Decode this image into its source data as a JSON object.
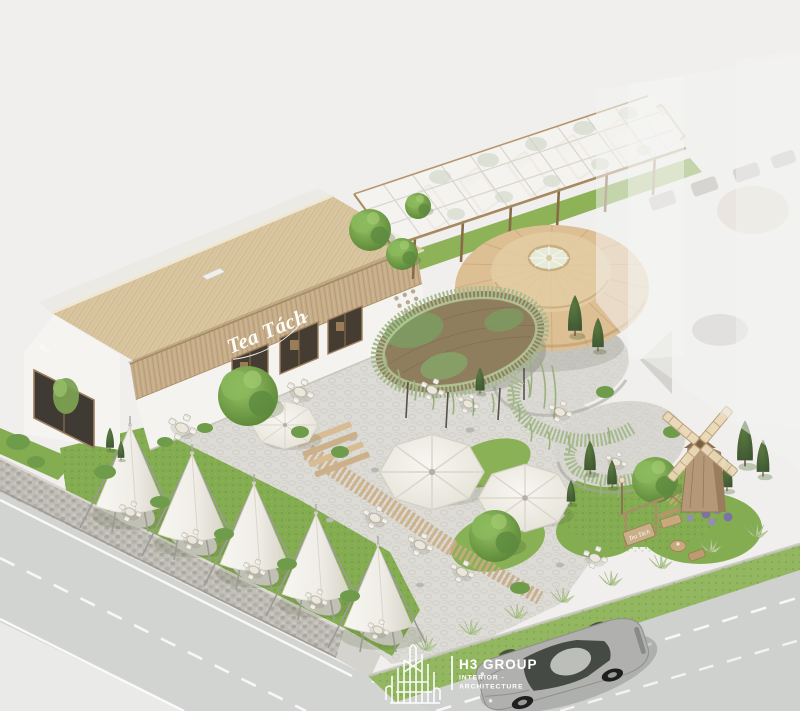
{
  "meta": {
    "title": "Tea house aerial architectural render",
    "render_type": "3D exterior visualization, aerial corner view"
  },
  "branding": {
    "main_sign": "Tea Tách",
    "gable_sign": "Tea",
    "entrance_sign": "Tea Tách"
  },
  "logo": {
    "name": "H3 GROUP",
    "line1": "INTERIOR -",
    "line2": "ARCHITECTURE",
    "color": "#ffffff"
  },
  "palette": {
    "background": "#f0efed",
    "road_left": "#d2d4d2",
    "road_right": "#cfd1cf",
    "sidewalk": "#eaeae8",
    "stone_wall": "#bfbdb6",
    "paving": "#dcdbd5",
    "grass": "#84ad52",
    "thatch_roof": "#d9c6a0",
    "rattan_facade": "#c6ad89",
    "parasol": "#ddbf94",
    "vine": "#a4b98b",
    "canopy_fabric": "#f2f0e9",
    "wood": "#b3926c",
    "car_body": "#b0b0ae",
    "sign_text": "#fdfcf8"
  }
}
